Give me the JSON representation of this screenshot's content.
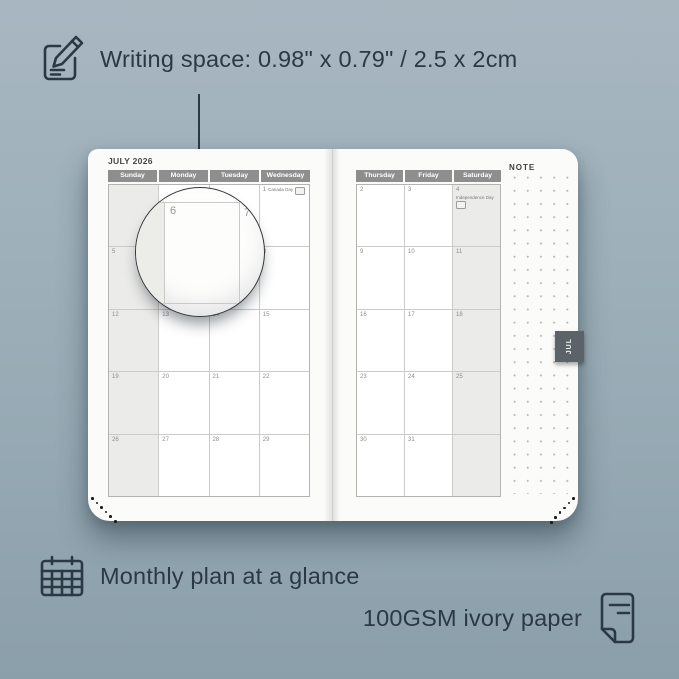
{
  "colors": {
    "background_top": "#a8b6c0",
    "background_bottom": "#8b9fab",
    "page": "#fbfbfa",
    "header_gray": "#8e8e8e",
    "shaded_column": "#ebebe9",
    "tab": "#5b6368",
    "annotation_text": "#2b3944"
  },
  "top_annotation": {
    "icon": "pencil-document-icon",
    "text": "Writing space: 0.98\" x 0.79\" / 2.5 x 2cm"
  },
  "bottom_annotations": {
    "monthly_icon": "calendar-grid-icon",
    "monthly": "Monthly plan at a glance",
    "paper": "100GSM ivory paper",
    "paper_icon": "paper-icon"
  },
  "planner": {
    "month_title": "JULY 2026",
    "note_label": "NOTE",
    "tab_label": "JUL",
    "left_calendar": {
      "day_headers": [
        "Sunday",
        "Monday",
        "Tuesday",
        "Wednesday"
      ],
      "weeks": [
        [
          "",
          "",
          "",
          "1"
        ],
        [
          "5",
          "6",
          "7",
          "8"
        ],
        [
          "12",
          "13",
          "14",
          "15"
        ],
        [
          "19",
          "20",
          "21",
          "22"
        ],
        [
          "26",
          "27",
          "28",
          "29"
        ]
      ],
      "holidays": [
        {
          "row": 0,
          "col": 3,
          "label": "Canada Day"
        }
      ],
      "shaded_col": 0
    },
    "right_calendar": {
      "day_headers": [
        "Thursday",
        "Friday",
        "Saturday"
      ],
      "weeks": [
        [
          "2",
          "3",
          "4"
        ],
        [
          "9",
          "10",
          "11"
        ],
        [
          "16",
          "17",
          "18"
        ],
        [
          "23",
          "24",
          "25"
        ],
        [
          "30",
          "31",
          ""
        ]
      ],
      "holidays": [
        {
          "row": 0,
          "col": 2,
          "label": "Independence Day"
        }
      ],
      "shaded_col": 2
    },
    "magnifier": {
      "date": "6",
      "next_date": "7"
    }
  }
}
